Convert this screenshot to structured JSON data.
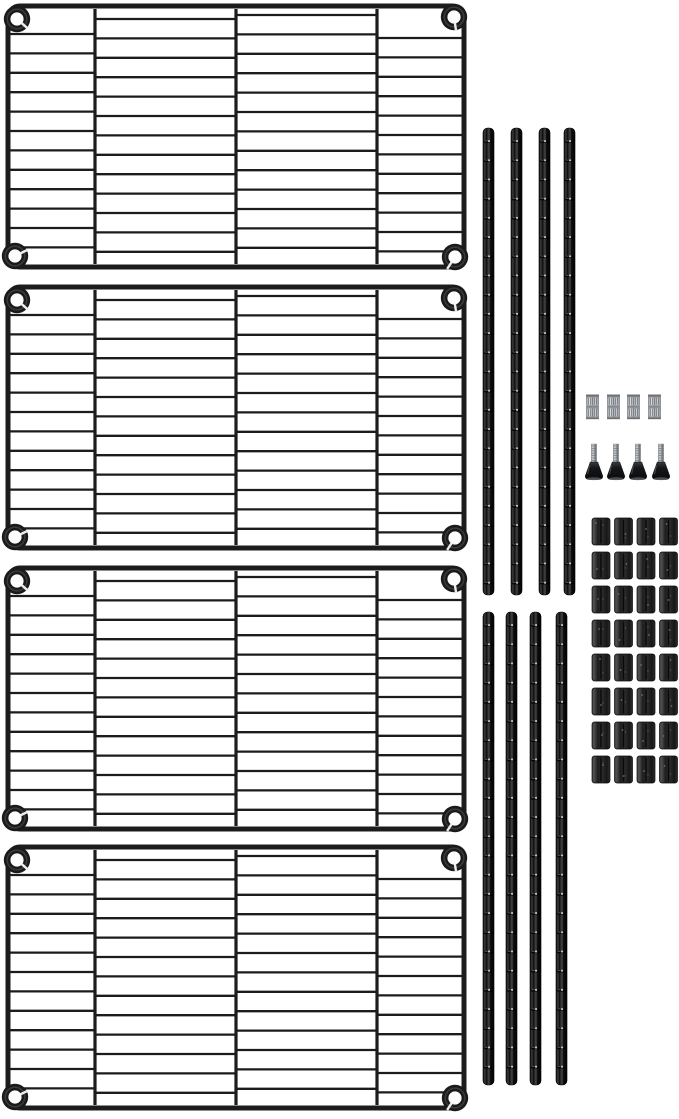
{
  "image": {
    "kind": "product-photo",
    "subject": "Black wire shelving unit kit shown disassembled on a white background",
    "background_color": "#ffffff"
  },
  "parts": {
    "wire_shelves": {
      "label": "wire shelf",
      "count": 4,
      "columns_per_shelf": 4,
      "wire_rows_middle_columns": 13,
      "wire_rows_outer_columns": 12,
      "corner_collars_per_shelf": 4,
      "color": "#1c1c1c"
    },
    "shelf_poles": {
      "label": "segmented shelf pole",
      "groups": 2,
      "poles_per_group": 4,
      "total": 8,
      "color": "#0b0b0b",
      "groove_highlight_color": "#cfcfcf"
    },
    "knurled_nut_sets": {
      "label": "knurled nut set",
      "count": 4,
      "color": "#b7bcc0",
      "knurl_color": "#5a6065"
    },
    "leveling_feet": {
      "label": "leveling foot",
      "count": 4,
      "stem_color": "#b3b7bb",
      "base_color": "#141517"
    },
    "sleeve_clips": {
      "label": "split sleeve clip",
      "count": 32,
      "rows": 8,
      "columns": 4,
      "color": "#242424"
    }
  }
}
